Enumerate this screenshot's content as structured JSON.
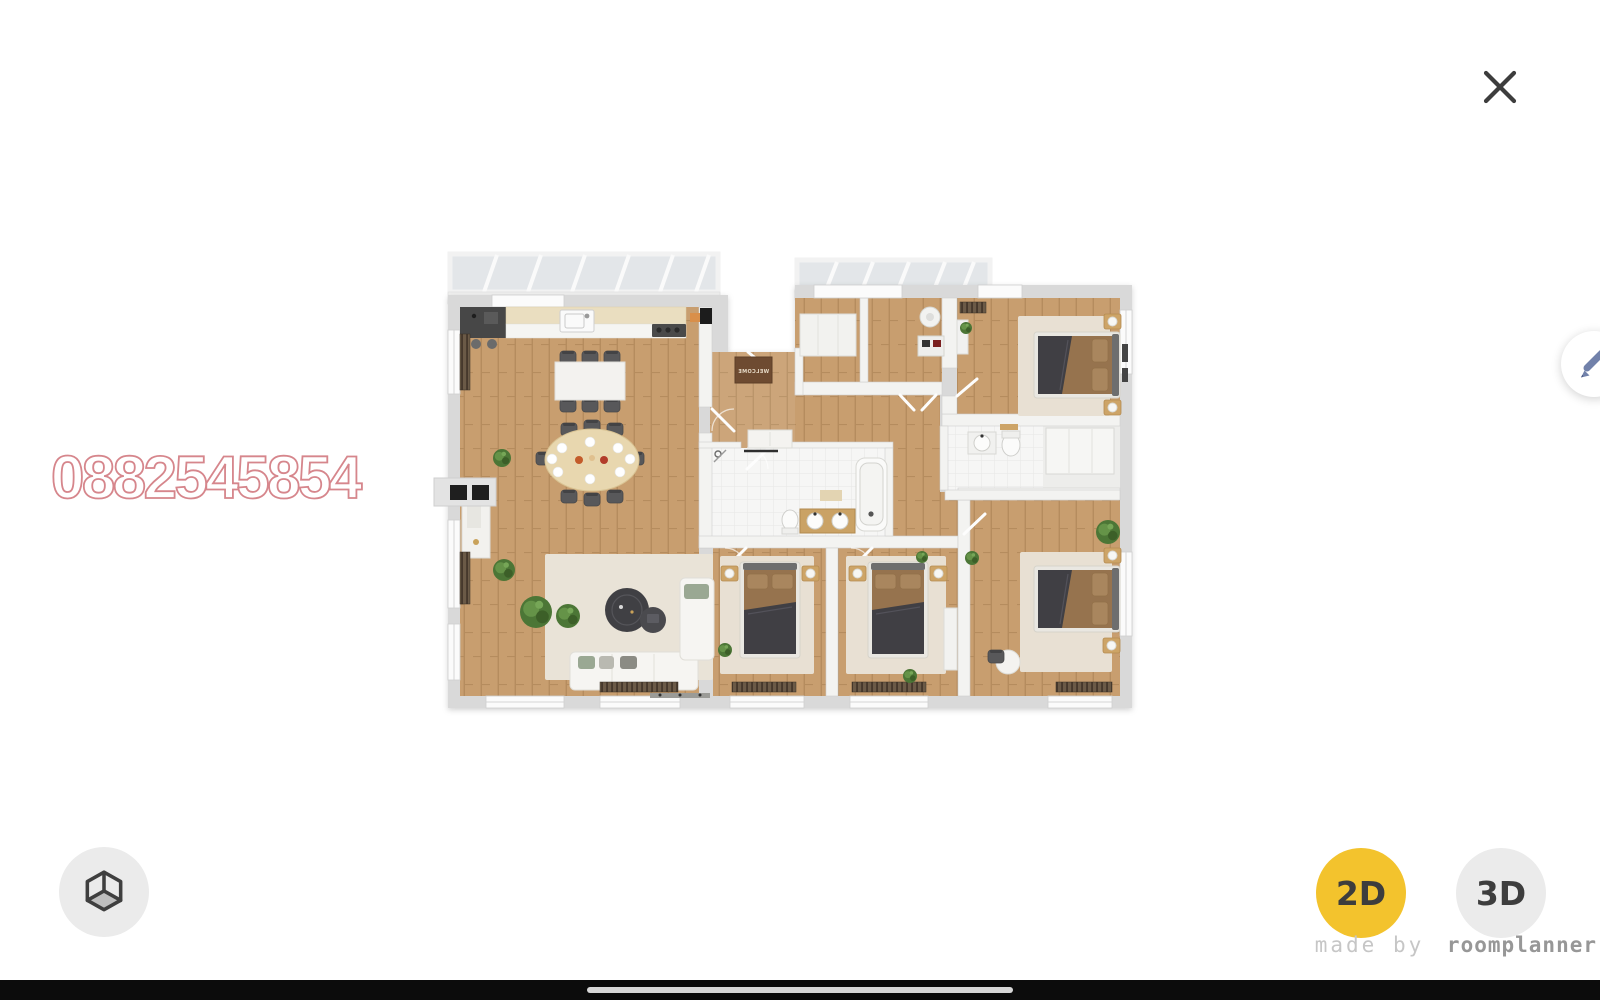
{
  "header": {
    "close_button": {
      "icon": "close-x-icon"
    }
  },
  "watermark": {
    "phone_number": "0882545854"
  },
  "floorplan": {
    "view_mode": "2D",
    "welcome_mat_text": "WELCOME",
    "rooms": [
      "living-dining-kitchen",
      "entry-hall",
      "storage-room",
      "laundry-room",
      "master-bedroom",
      "main-bathroom",
      "wc",
      "closet-niche",
      "hallway",
      "bedroom-2",
      "bedroom-3",
      "bedroom-4",
      "glass-roof-terrace-left",
      "glass-roof-terrace-right"
    ]
  },
  "side_controls": {
    "edit_button": {
      "icon": "pencil-icon"
    }
  },
  "bottom_controls": {
    "cube_button": {
      "icon": "cube-3d-icon"
    },
    "view_toggle": {
      "active": "2D",
      "options": [
        {
          "label": "2D",
          "active": true
        },
        {
          "label": "3D",
          "active": false
        }
      ]
    }
  },
  "credit": {
    "prefix": "made by",
    "brand": "roomplanner"
  },
  "system": {
    "home_indicator": true
  },
  "theme": {
    "accent-yellow": "#f3c32d",
    "button-gray": "#ebebeb",
    "icon-dark": "#3d3d3d",
    "watermark-pink": "#d6868c",
    "pencil-blue": "#7181aa",
    "wall-gray": "#d9d9d9",
    "wood-floor": "#c89e6f",
    "bathroom-tile": "#f6f6f5",
    "rug-beige": "#e8e0d3",
    "bed-brown": "#96734e",
    "bed-throw-dark": "#403f44",
    "plant-green": "#4c7636"
  }
}
